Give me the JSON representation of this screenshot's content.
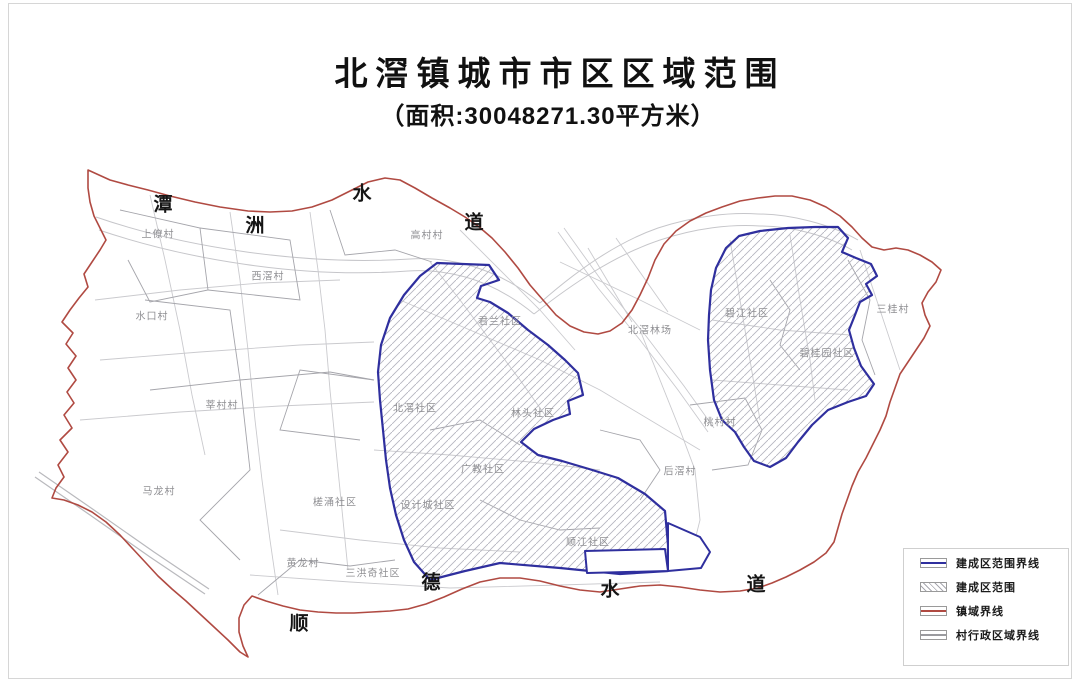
{
  "title": {
    "main": "北滘镇城市市区区域范围",
    "subtitle": "（面积:30048271.30平方米）"
  },
  "map": {
    "waterway_labels": [
      {
        "text": "潭",
        "x": 163,
        "y": 203
      },
      {
        "text": "洲",
        "x": 255,
        "y": 224
      },
      {
        "text": "水",
        "x": 362,
        "y": 192
      },
      {
        "text": "道",
        "x": 474,
        "y": 221
      },
      {
        "text": "顺",
        "x": 299,
        "y": 622
      },
      {
        "text": "德",
        "x": 431,
        "y": 581
      },
      {
        "text": "水",
        "x": 610,
        "y": 588
      },
      {
        "text": "道",
        "x": 756,
        "y": 583
      }
    ],
    "area_labels": [
      {
        "text": "上僚村",
        "x": 158,
        "y": 233
      },
      {
        "text": "西滘村",
        "x": 268,
        "y": 275
      },
      {
        "text": "水口村",
        "x": 152,
        "y": 315
      },
      {
        "text": "高村村",
        "x": 427,
        "y": 234
      },
      {
        "text": "君兰社区",
        "x": 500,
        "y": 320
      },
      {
        "text": "北滘林场",
        "x": 650,
        "y": 329
      },
      {
        "text": "碧江社区",
        "x": 747,
        "y": 312
      },
      {
        "text": "三桂村",
        "x": 893,
        "y": 308
      },
      {
        "text": "碧桂园社区",
        "x": 827,
        "y": 352
      },
      {
        "text": "莘村村",
        "x": 222,
        "y": 404
      },
      {
        "text": "北滘社区",
        "x": 415,
        "y": 407
      },
      {
        "text": "林头社区",
        "x": 533,
        "y": 412
      },
      {
        "text": "桃村村",
        "x": 720,
        "y": 421
      },
      {
        "text": "马龙村",
        "x": 159,
        "y": 490
      },
      {
        "text": "广教社区",
        "x": 483,
        "y": 468
      },
      {
        "text": "后滘村",
        "x": 680,
        "y": 470
      },
      {
        "text": "槎涌社区",
        "x": 335,
        "y": 501
      },
      {
        "text": "设计城社区",
        "x": 428,
        "y": 504
      },
      {
        "text": "顺江社区",
        "x": 588,
        "y": 541
      },
      {
        "text": "黄龙村",
        "x": 303,
        "y": 562
      },
      {
        "text": "三洪奇社区",
        "x": 373,
        "y": 572
      }
    ]
  },
  "legend": {
    "items": [
      {
        "label": "建成区范围界线",
        "swatch": "blue-line",
        "color": "#2f2f9e"
      },
      {
        "label": "建成区范围",
        "swatch": "hatch",
        "color": "#a8a8b0"
      },
      {
        "label": "镇域界线",
        "swatch": "red-line",
        "color": "#b04a42"
      },
      {
        "label": "村行政区域界线",
        "swatch": "gray-line",
        "color": "#9a9a9e"
      }
    ]
  },
  "colors": {
    "built_boundary": "#2f2f9e",
    "town_boundary": "#b04a42",
    "village_boundary": "#a5a5ab",
    "road": "#cacace",
    "hatch": "#b6b6c0",
    "area_label": "#8f8f93"
  }
}
